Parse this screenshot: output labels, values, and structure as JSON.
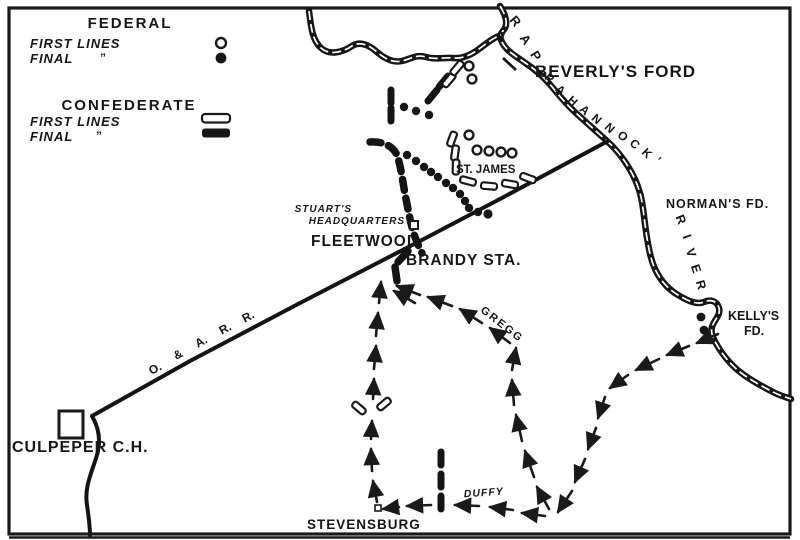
{
  "legend": {
    "federal_title": "FEDERAL",
    "federal_first_label": "FIRST LINES",
    "federal_final_label": "FINAL",
    "confederate_title": "CONFEDERATE",
    "confederate_first_label": "FIRST LINES",
    "confederate_final_label": "FINAL",
    "ditto_mark": "”"
  },
  "places": {
    "beverlys_ford": "BEVERLY'S FORD",
    "normans_ford": "NORMAN'S FD.",
    "kellys_ford_line1": "KELLY'S",
    "kellys_ford_line2": "FD.",
    "st_james": "ST. JAMES",
    "stuarts_hq_line1": "STUART'S",
    "stuarts_hq_line2": "HEADQUARTERS",
    "fleetwood": "FLEETWOOD",
    "brandy_station": "BRANDY STA.",
    "culpeper": "CULPEPER C.H.",
    "stevensburg": "STEVENSBURG"
  },
  "routes": {
    "gregg": "GREGG",
    "duffy": "DUFFY"
  },
  "letters": {
    "railroad": [
      "O.",
      "&",
      "A.",
      "R.",
      "R."
    ],
    "rap": [
      "R",
      "A",
      "P"
    ],
    "pahannock": [
      "P",
      "A",
      "H",
      "A",
      "N",
      "N",
      "O",
      "C",
      "K",
      "’"
    ],
    "river": [
      "R",
      "I",
      "V",
      "E",
      "R"
    ]
  },
  "colors": {
    "ink": "#1a1a1a",
    "paper": "#ffffff"
  }
}
